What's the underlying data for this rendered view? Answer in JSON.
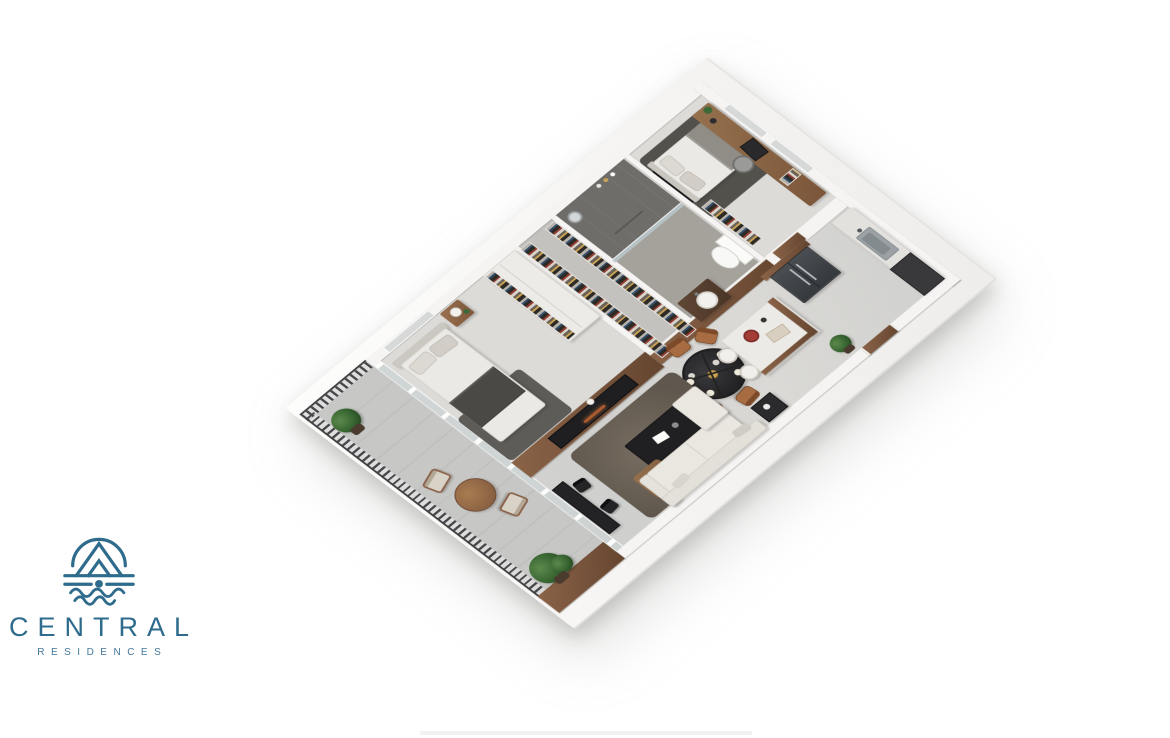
{
  "brand": {
    "name": "CENTRAL",
    "subtitle": "RESIDENCES",
    "color": "#2e6b8c"
  },
  "palette": {
    "background": "#ffffff",
    "wall_white": "#f5f4f2",
    "wood_accent": "#7d5a42",
    "floor_gray": "#d4d3d1",
    "dark_furniture": "#232325",
    "railing_dark": "#3f4042",
    "plant_green": "#35622f",
    "dining_chair_caramel": "#a86c42",
    "fridge_graphite": "#43464a"
  },
  "floorplan": {
    "type": "isometric-3d-apartment-render",
    "view": "axonometric top view, rotated",
    "rooms": [
      {
        "name": "balcony",
        "features": [
          "dark slat railing",
          "round wood table",
          "two chairs",
          "potted plants",
          "wood privacy wall"
        ]
      },
      {
        "name": "master-bedroom",
        "features": [
          "double bed with dark throw",
          "nightstand with lamp",
          "white wardrobe with clothes",
          "window"
        ]
      },
      {
        "name": "walk-in-closet",
        "features": [
          "open wardrobes with clothes"
        ]
      },
      {
        "name": "bathroom",
        "features": [
          "dark tiled shower with glass",
          "toilet",
          "walnut vanity with basin"
        ]
      },
      {
        "name": "bedroom-2",
        "features": [
          "bed",
          "wall tv",
          "open clothes rack",
          "desk with laptop",
          "office chair",
          "windows"
        ]
      },
      {
        "name": "kitchen",
        "features": [
          "graphite double-door fridge with walnut surround",
          "counter with steel sink",
          "dark cabinet"
        ]
      },
      {
        "name": "dining-area",
        "features": [
          "round dark table",
          "five caramel wood chairs",
          "black chandelier with glass globes"
        ]
      },
      {
        "name": "kitchen-island",
        "features": [
          "white top",
          "walnut base",
          "two stools",
          "red bowl"
        ]
      },
      {
        "name": "living-room",
        "features": [
          "walnut media wall with fireplace",
          "dark rug",
          "black coffee table",
          "wood side table with plant",
          "cream sectional sofa",
          "black work desk with two chairs"
        ]
      }
    ]
  }
}
